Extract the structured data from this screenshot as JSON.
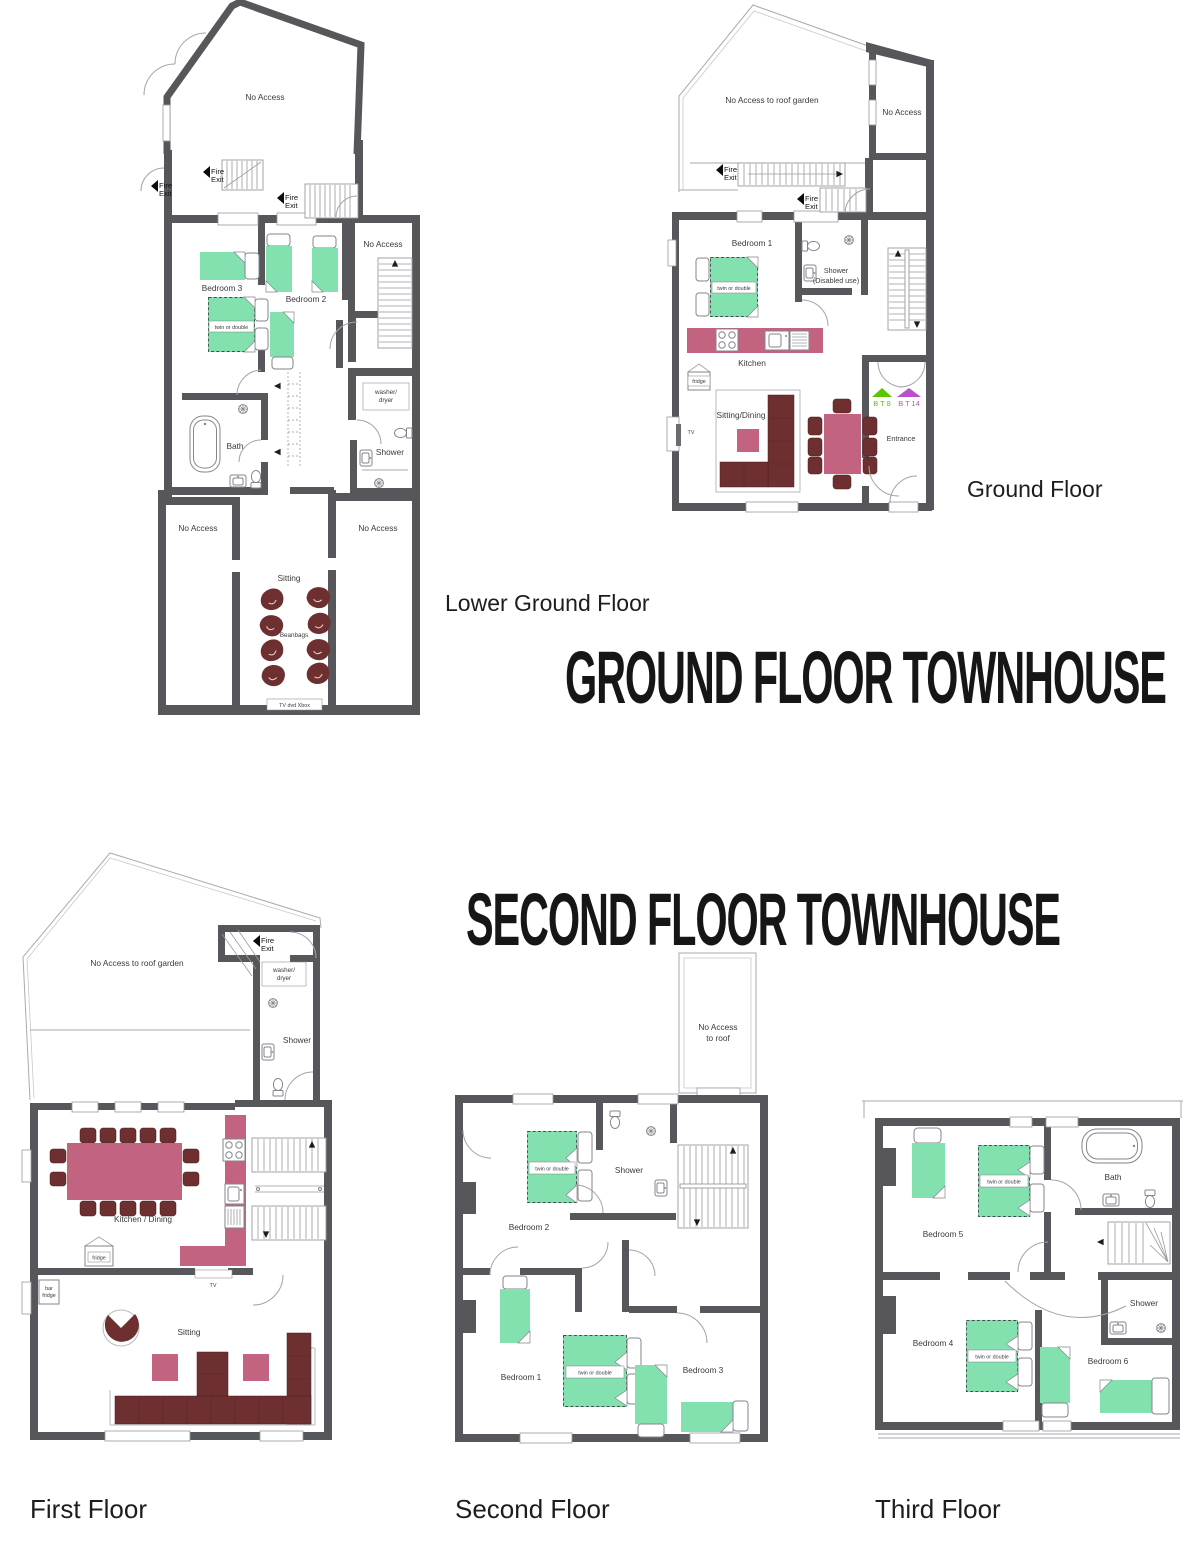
{
  "titles": {
    "section1": "GROUND FLOOR TOWNHOUSE",
    "section2": "SECOND FLOOR TOWNHOUSE"
  },
  "captions": {
    "lower_ground": "Lower Ground Floor",
    "ground": "Ground Floor",
    "first": "First Floor",
    "second": "Second Floor",
    "third": "Third Floor"
  },
  "colors": {
    "wall": "#57575b",
    "bed_green": "#82e1ae",
    "sofa_maroon": "#6e2f31",
    "table_pink": "#c2637f",
    "bt8_green": "#5bc500",
    "bt14_purple": "#b94fc9"
  },
  "common": {
    "fire": "Fire",
    "exit": "Exit",
    "no_access": "No Access",
    "twin_or_double": "twin or double",
    "shower": "Shower",
    "bath": "Bath",
    "sitting": "Sitting",
    "fridge": "fridge",
    "tv": "TV",
    "washer": "washer/",
    "dryer": "dryer"
  },
  "lower_ground": {
    "bedroom3": "Bedroom 3",
    "bedroom2": "Bedroom 2",
    "beanbags": "Beanbags",
    "tv_dvd_xbox": "TV  dvd  Xbox"
  },
  "ground": {
    "roof_garden": "No Access to roof garden",
    "bedroom1": "Bedroom 1",
    "disabled_use": "(Disabled use)",
    "kitchen": "Kitchen",
    "sitting_dining": "Sitting/Dining",
    "entrance": "Entrance",
    "bt8": "B T 8",
    "bt14": "B T 14"
  },
  "first": {
    "roof_garden": "No Access to roof garden",
    "kitchen_dining": "Kitchen / Dining",
    "bar": "bar"
  },
  "second": {
    "no_access_roof": [
      "No Access",
      "to roof"
    ],
    "bedroom1": "Bedroom 1",
    "bedroom2": "Bedroom 2",
    "bedroom3": "Bedroom 3"
  },
  "third": {
    "bedroom4": "Bedroom 4",
    "bedroom5": "Bedroom 5",
    "bedroom6": "Bedroom 6"
  }
}
